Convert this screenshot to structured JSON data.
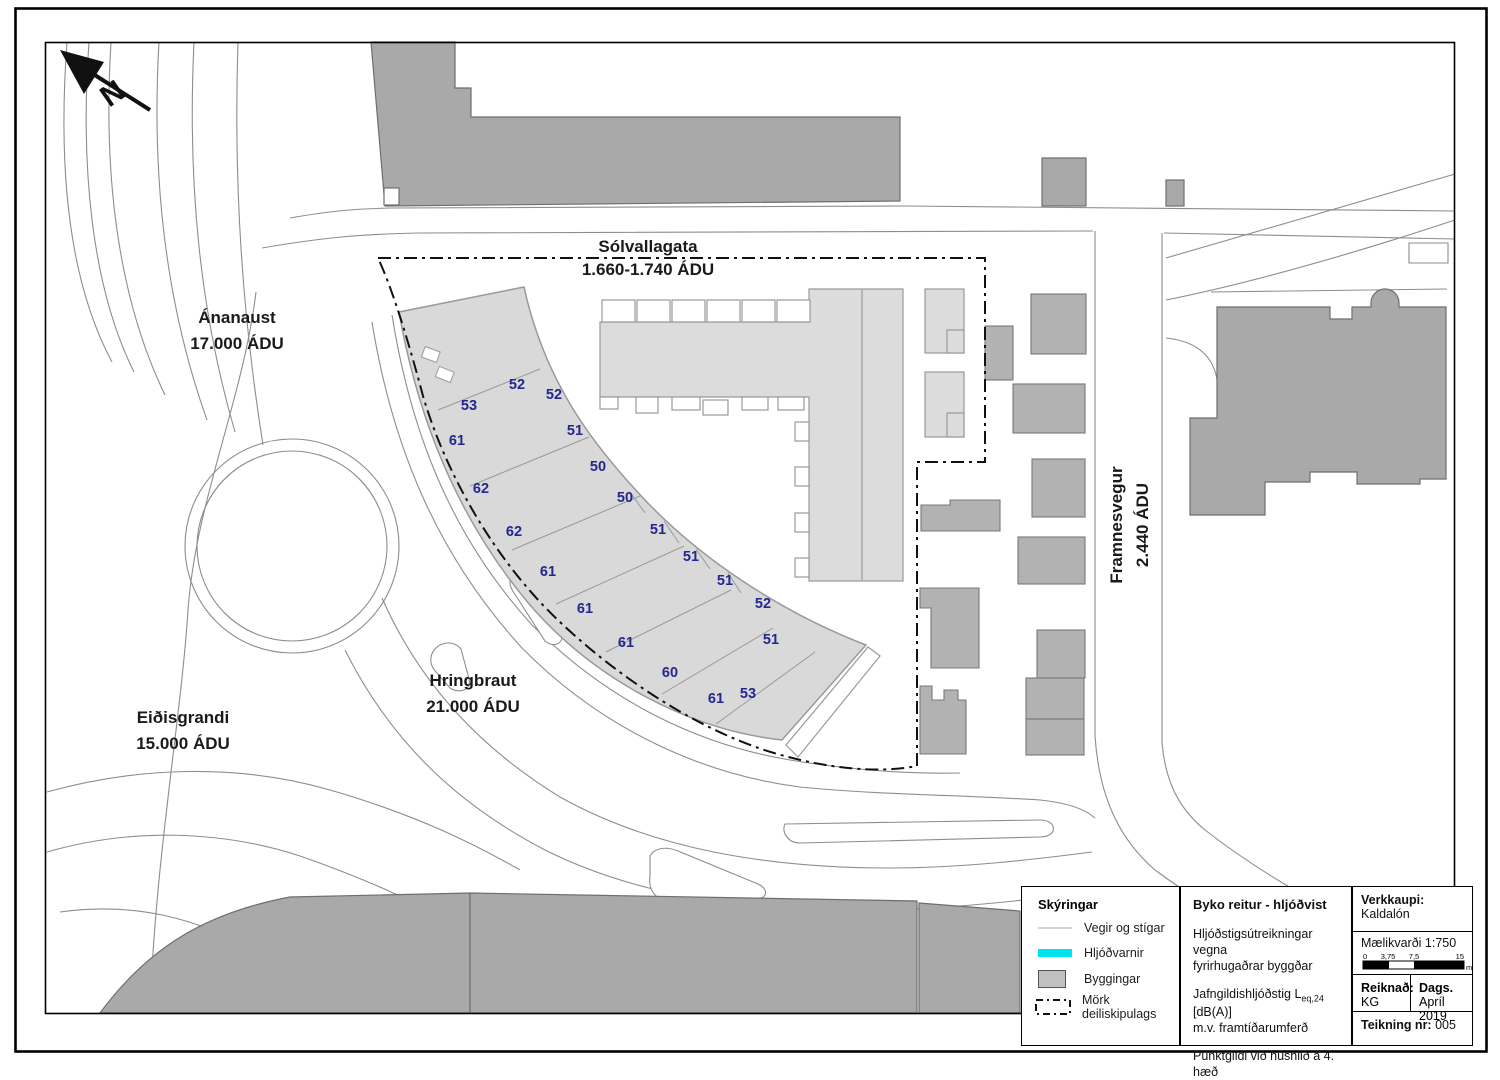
{
  "map": {
    "north_label": "N",
    "road_labels": [
      {
        "name": "Sólvallagata",
        "traffic": "1.660-1.740 ÁDU"
      },
      {
        "name": "Ánanaust",
        "traffic": "17.000 ÁDU"
      },
      {
        "name": "Framnesvegur",
        "traffic": "2.440 ÁDU"
      },
      {
        "name": "Hringbraut",
        "traffic": "21.000 ÁDU"
      },
      {
        "name": "Eiðisgrandi",
        "traffic": "15.000 ÁDU"
      }
    ],
    "noise_values": [
      "53",
      "52",
      "52",
      "61",
      "51",
      "62",
      "50",
      "62",
      "50",
      "61",
      "51",
      "61",
      "51",
      "51",
      "52",
      "61",
      "51",
      "60",
      "53",
      "61"
    ]
  },
  "legend": {
    "title": "Skýringar",
    "items": [
      {
        "label": "Vegir og stígar"
      },
      {
        "label": "Hljóðvarnir"
      },
      {
        "label": "Byggingar"
      },
      {
        "label": "Mörk deiliskipulags"
      }
    ],
    "colors": {
      "noise_barrier": "#00e4f2",
      "building": "#c0c0c0"
    }
  },
  "title_block": {
    "title": "Byko reitur - hljóðvist",
    "description_line1": "Hljóðstigsútreikningar vegna",
    "description_line2": "fyrirhugaðrar byggðar",
    "metric_prefix": "Jafngildishljóðstig L",
    "metric_sub": "eq,24",
    "metric_suffix": " [dB(A)]",
    "metric_line2": "m.v. framtíðarumferð",
    "note": "Punktgildi við húshlið á 4. hæð",
    "client_label": "Verkkaupi:",
    "client": "Kaldalón",
    "scale_label": "Mælikvarði 1:750",
    "scale_ticks": [
      "0",
      "3,75",
      "7,5",
      "15"
    ],
    "scale_unit": "m",
    "calculated_label": "Reiknað:",
    "calculated_value": "KG",
    "date_label": "Dags.",
    "date_value": "Apríl 2019",
    "drawing_label": "Teikning nr:",
    "drawing_number": "005"
  }
}
